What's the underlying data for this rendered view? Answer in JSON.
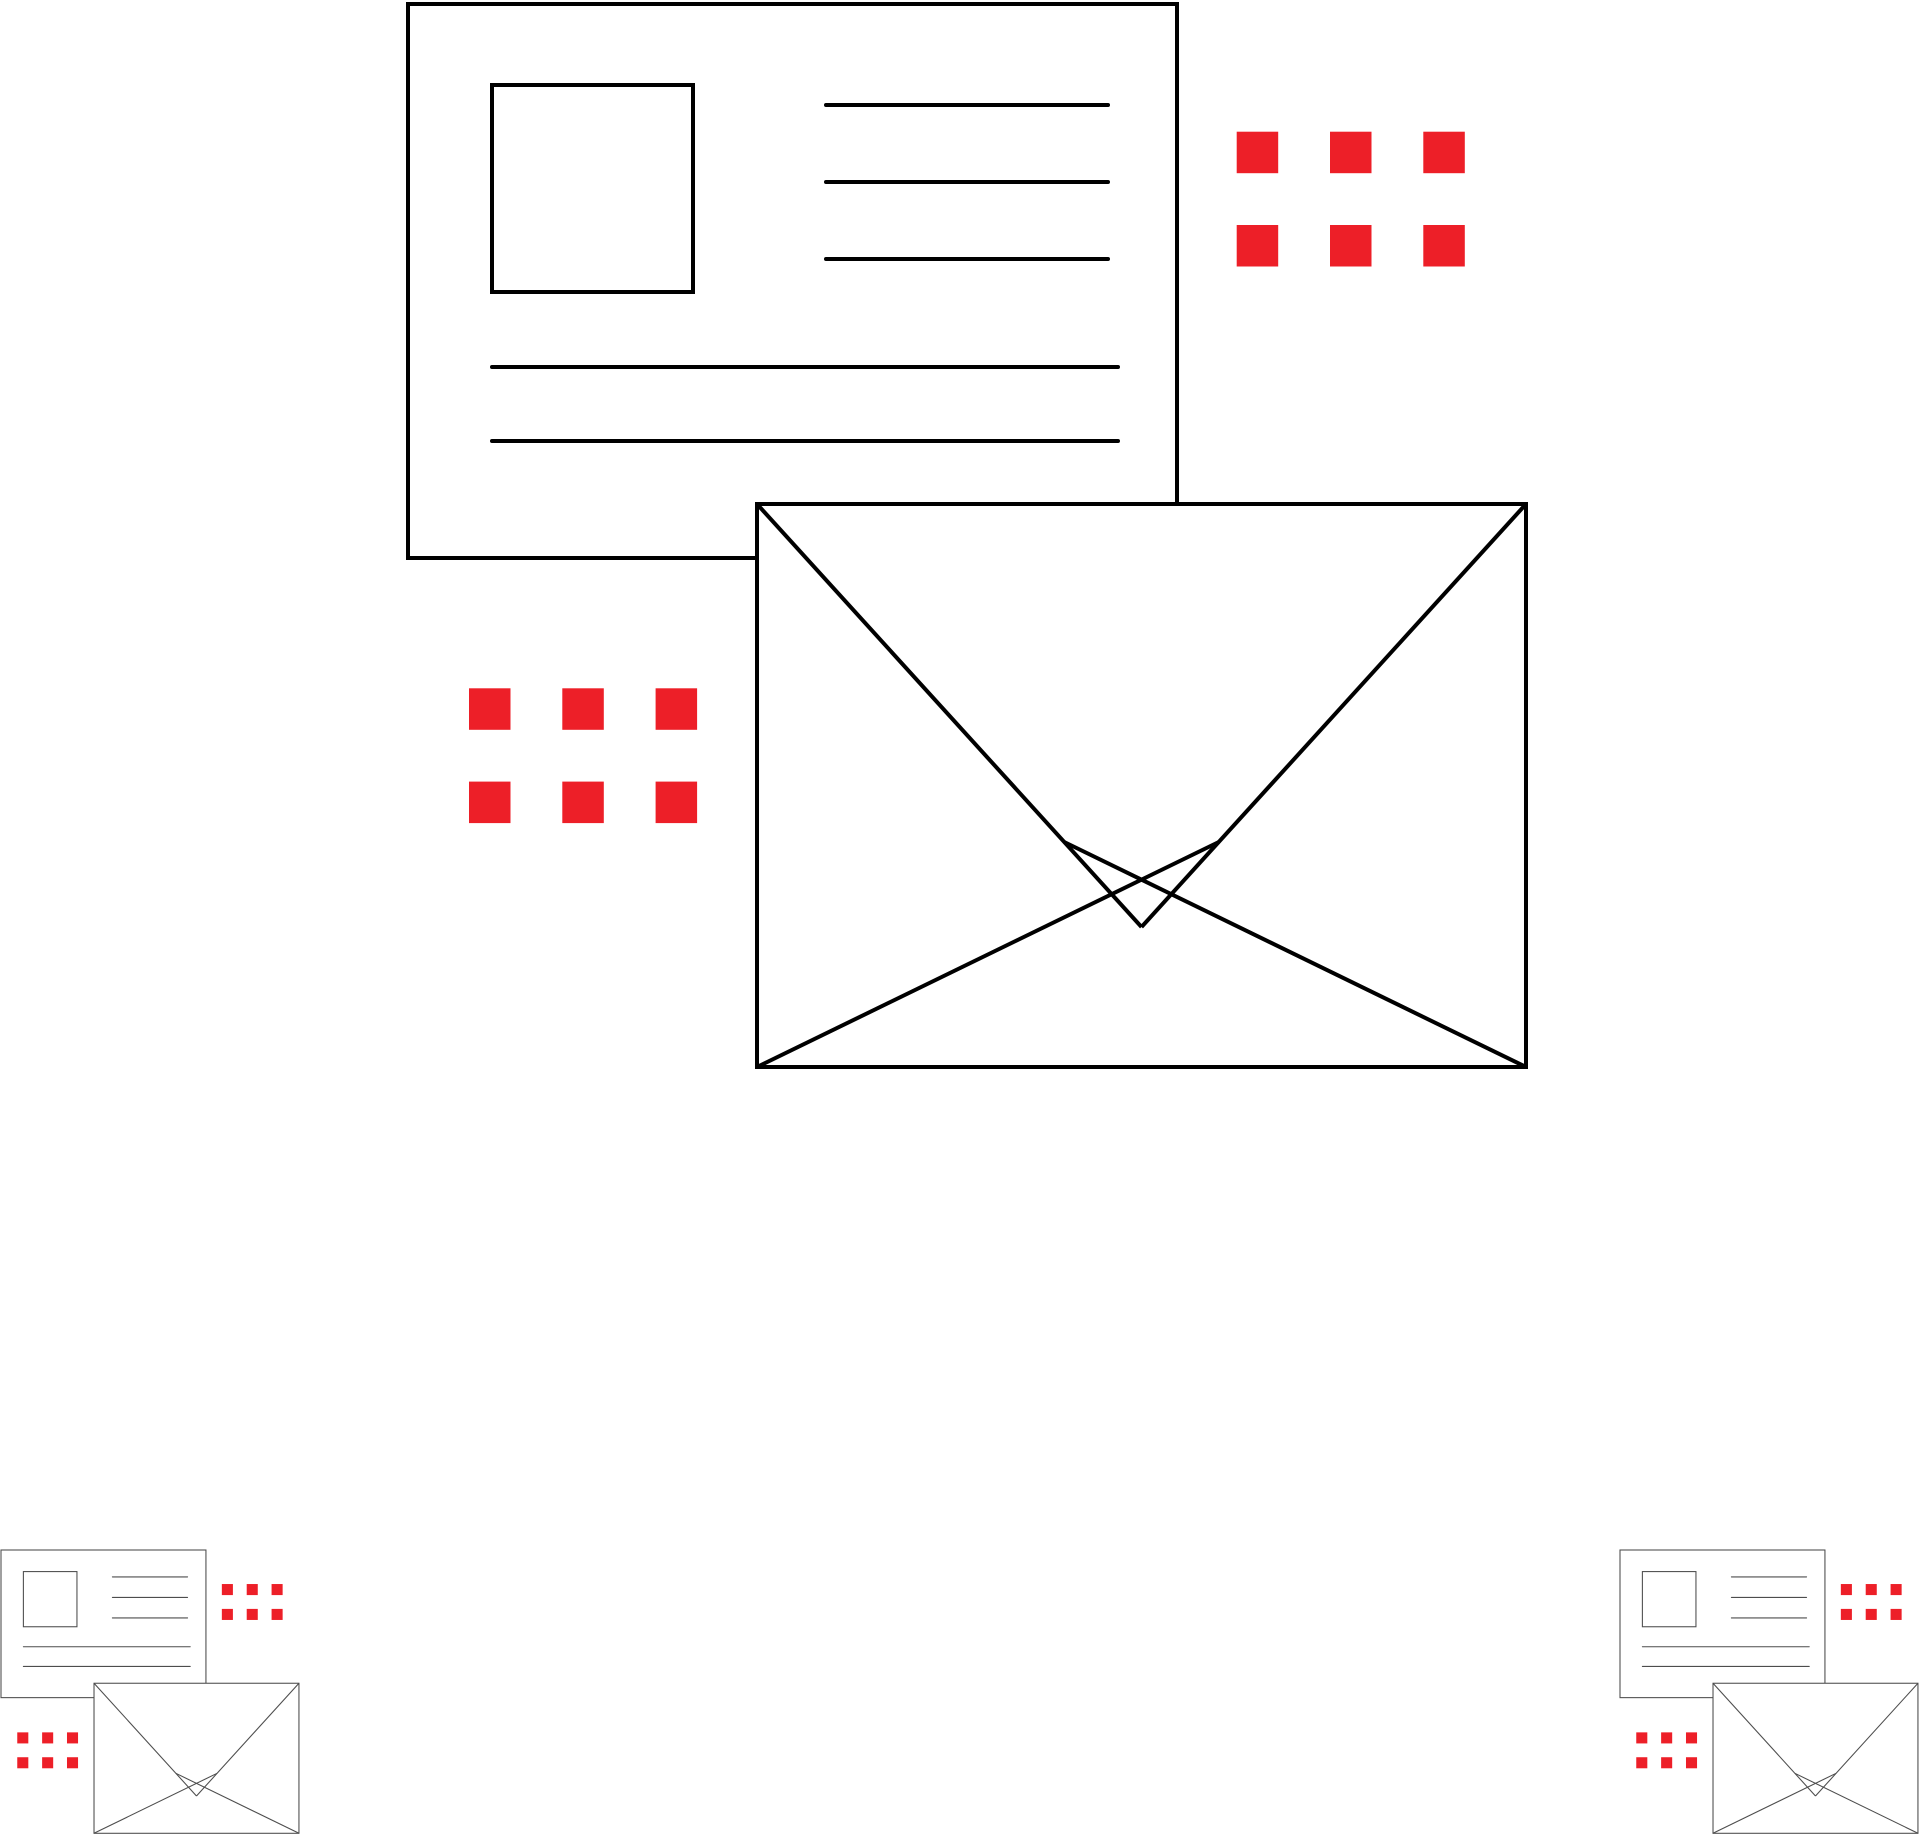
{
  "page": {
    "width": 1920,
    "height": 1836,
    "background": "#ffffff",
    "description": "Mailing / post icon illustration: postcard with address lines, envelope, red dot grids; one large bold icon group and two small thin-line copies at bottom corners"
  },
  "palette": {
    "bold_stroke": "#000000",
    "thin_stroke": "#4d4d4d",
    "accent_red": "#ED1F28",
    "shape_fill": "#ffffff"
  },
  "icon_geometry": {
    "viewbox": {
      "width": 1118,
      "height": 1063
    },
    "stroke_width": 4,
    "postcard": {
      "x": 0,
      "y": 0,
      "width": 769,
      "height": 554
    },
    "photo_square": {
      "x": 84,
      "y": 81,
      "width": 201,
      "height": 207
    },
    "short_lines": {
      "x1": 418,
      "x2": 700,
      "ys": [
        101,
        178,
        255
      ]
    },
    "long_lines": {
      "x1": 84,
      "x2": 710,
      "ys": [
        363,
        437
      ]
    },
    "envelope": {
      "x": 349,
      "y": 500,
      "width": 769,
      "height": 563
    },
    "flap_point": {
      "x": 733.5,
      "y": 923
    },
    "fold_lines": [
      {
        "x1": 349,
        "y1": 1063,
        "x2": 810.8,
        "y2": 838
      },
      {
        "x1": 1118,
        "y1": 1063,
        "x2": 656.2,
        "y2": 838
      }
    ],
    "dot_grids": [
      {
        "name": "dots-grid-top-right",
        "x": 828.7,
        "y": 127.7
      },
      {
        "name": "dots-grid-mid-left",
        "x": 61,
        "y": 684.3
      }
    ],
    "dot": {
      "size": 41.5,
      "pitch": 93.3,
      "cols": 3,
      "rows": 2
    }
  },
  "instances": [
    {
      "id": "mailing-icon-large",
      "x": 408,
      "y": 4,
      "scale": 1,
      "stroke": "#000000",
      "style": "bold"
    },
    {
      "id": "mailing-icon-small-left",
      "x": 1,
      "y": 1550,
      "scale": 0.2665,
      "stroke": "#4d4d4d",
      "style": "thin"
    },
    {
      "id": "mailing-icon-small-right",
      "x": 1620,
      "y": 1550,
      "scale": 0.2665,
      "stroke": "#4d4d4d",
      "style": "thin"
    }
  ]
}
